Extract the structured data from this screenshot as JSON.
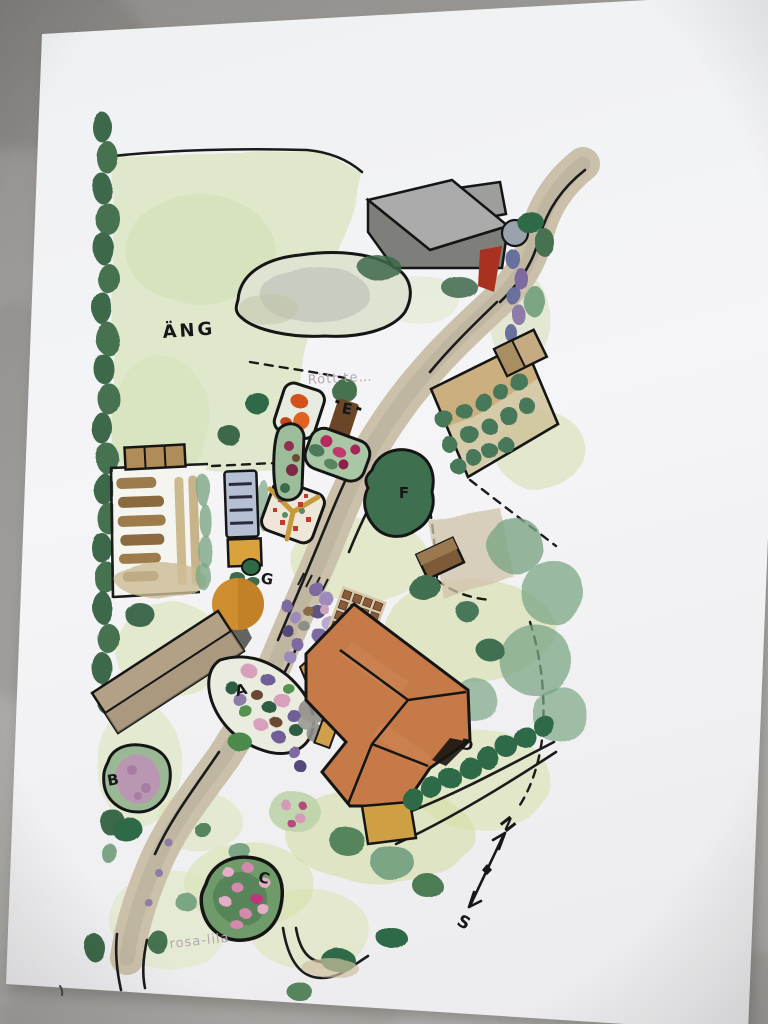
{
  "scene": {
    "description": "Photo of a hand-drawn watercolor garden site plan on white paper lying on a gray concrete surface",
    "media": "watercolor and ink sketch"
  },
  "labels": {
    "meadow": "ÄNG",
    "note_red_bed": "Rött te…",
    "note_pink_lilac": "rosa-lila"
  },
  "markers": {
    "A": "A",
    "B": "B",
    "C": "C",
    "D": "D",
    "E": "E",
    "F": "F",
    "G": "G"
  },
  "compass": {
    "north": "N",
    "south": "S"
  },
  "palette": {
    "background_gray": "#a6a4a1",
    "paper_white": "#f3f4f6",
    "road_tan": "#cbc0a9",
    "meadow_green": "#dde7c6",
    "lawn_green": "#d2dd9e",
    "tree_dark_green": "#3c684a",
    "tree_soft_green": "#7ca585",
    "roof_terracotta": "#c57a48",
    "barn_gray": "#a8a8a8",
    "barn_tan": "#b3a185",
    "greenhouse_blue": "#b6c0d4",
    "accent_orange": "#d9a23c",
    "orange_tree": "#ce8d2e",
    "flower_magenta": "#b62a62",
    "flower_purple": "#7b6ba0",
    "flower_pink": "#d9a0bd",
    "brick_brown": "#8a5a38",
    "gable_red": "#a93120",
    "pencil_gray": "#b2a6ae"
  }
}
